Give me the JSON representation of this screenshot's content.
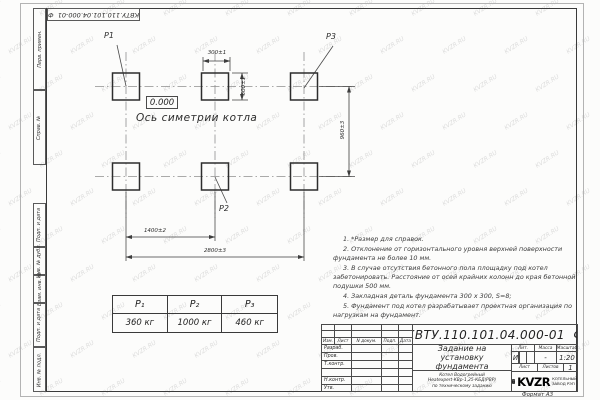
{
  "page": {
    "watermark": "KVZR.RU",
    "format_label": "Формат А3"
  },
  "margin_labels": {
    "perv_primen": "Перв. примен.",
    "sprav_no": "Справ. №",
    "podp_data_1": "Подп. и дата",
    "inv_dubl": "Инв. № дубл.",
    "vzam_inv": "Взам. инв. №",
    "podp_data_2": "Подп. и дата",
    "inv_podl": "Инв. № подл."
  },
  "top_stamp": {
    "doc_number": "КВТУ.110.101.04.000-01  Ф"
  },
  "drawing": {
    "labels": {
      "p1": "P1",
      "p2": "P2",
      "p3": "P3"
    },
    "elevation": "0.000",
    "axis_label": "Ось симетрии котла",
    "dimensions": {
      "block_width": "300±1",
      "block_height": "300±1",
      "row_spacing": "960±3",
      "col_spacing": "1400±2",
      "total_width": "2800±3"
    }
  },
  "load_table": {
    "headers": [
      "P₁",
      "P₂",
      "P₃"
    ],
    "values": [
      "360 кг",
      "1000 кг",
      "460 кг"
    ]
  },
  "notes": [
    "1. *Размер для справок.",
    "2. Отклонение от горизонтального уровня верхней поверхности фундамента не более 10 мм.",
    "3. В случае отсутствия бетонного пола площадку под котел забетонировать. Расстояние от осей крайних колонн до края бетонной подушки 500 мм.",
    "4. Закладная деталь фундамента 300 x 300, S=8;",
    "5. Фундамент под котел разрабатывает проектная организация по нагрузкам на фундамент."
  ],
  "title_block": {
    "doc_number": "КВТУ.110.101.04.000-01  Ф",
    "title_lines": [
      "Задание на",
      "установку",
      "фундамента"
    ],
    "subtitle_lines": [
      "Котел Водогрейный",
      "Heatexpert-КВр-1,25-КБД(РВР)",
      "по техническому заданию"
    ],
    "header_cols": [
      "Изм.",
      "Лист",
      "N докум.",
      "Подп.",
      "Дата"
    ],
    "rows": [
      "Разраб.",
      "Пров.",
      "Т.контр.",
      "",
      "Н.контр.",
      "Утв."
    ],
    "lit_header": "Лит.",
    "lit_value": "И",
    "massa_header": "Масса",
    "massa_value": "-",
    "masshtab_header": "Масштаб",
    "masshtab_value": "1:20",
    "list_label": "Лист",
    "listov_label": "Листов",
    "listov_value": "1",
    "logo_text": "KVZR",
    "org_lines": [
      "КОТЕЛЬНЫЙ",
      "ЗАВОД РЭП"
    ]
  }
}
